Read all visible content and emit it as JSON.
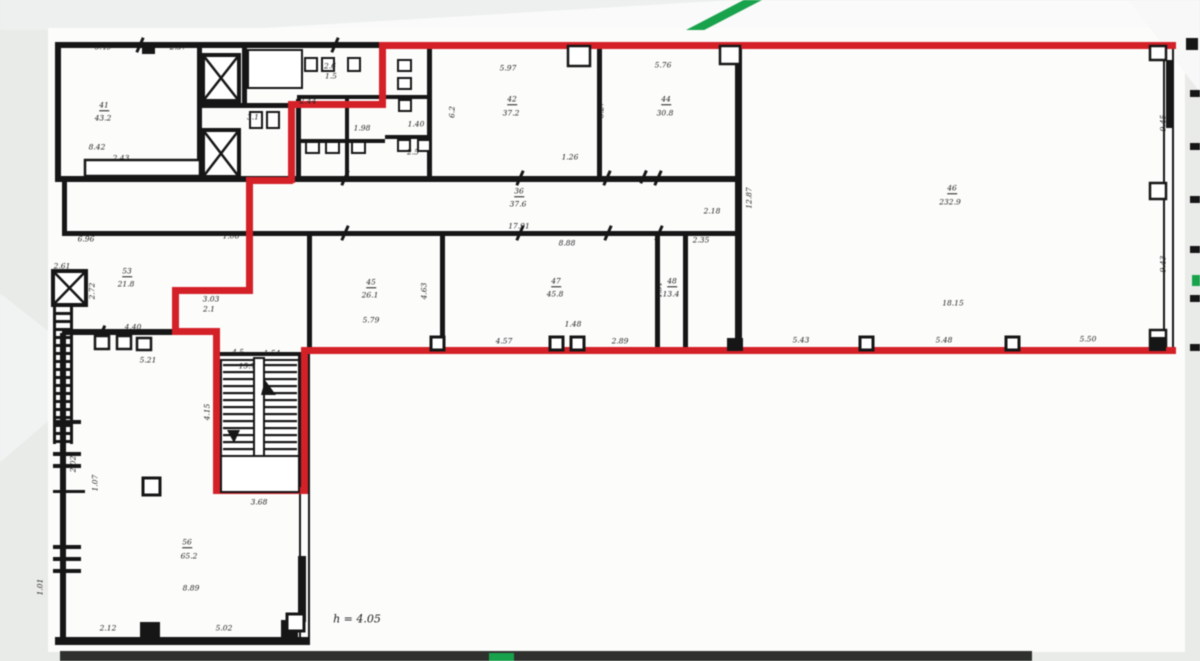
{
  "document": {
    "type": "scanned-floor-plan",
    "height_note": "h = 4.05",
    "colors": {
      "outline_red": "#d32127",
      "watermark_green": "#18a24c",
      "wall_black": "#161616",
      "paper": "#fcfcfb",
      "band_dark": "#30312f"
    }
  },
  "plan": {
    "labels": [
      {
        "t": "5.49",
        "x": 103,
        "y": 47
      },
      {
        "t": "2.37",
        "x": 178,
        "y": 47
      },
      {
        "t": "41",
        "x": 104,
        "y": 106,
        "u": 1
      },
      {
        "t": "43.2",
        "x": 103,
        "y": 118
      },
      {
        "t": "8.42",
        "x": 97,
        "y": 147
      },
      {
        "t": "2.43",
        "x": 121,
        "y": 158
      },
      {
        "t": "2.6",
        "x": 330,
        "y": 66
      },
      {
        "t": "1.5",
        "x": 331,
        "y": 76
      },
      {
        "t": "3.1",
        "x": 253,
        "y": 117
      },
      {
        "t": "2.44",
        "x": 308,
        "y": 101
      },
      {
        "t": "1.98",
        "x": 362,
        "y": 128
      },
      {
        "t": "1.40",
        "x": 416,
        "y": 124
      },
      {
        "t": "2.5",
        "x": 413,
        "y": 152
      },
      {
        "t": "6.2",
        "x": 452,
        "y": 112,
        "r": -90
      },
      {
        "t": "5.97",
        "x": 508,
        "y": 68
      },
      {
        "t": "42",
        "x": 512,
        "y": 100,
        "u": 1
      },
      {
        "t": "37.2",
        "x": 511,
        "y": 113
      },
      {
        "t": "6.27",
        "x": 601,
        "y": 110,
        "r": -90
      },
      {
        "t": "1.26",
        "x": 570,
        "y": 157
      },
      {
        "t": "5.76",
        "x": 663,
        "y": 65
      },
      {
        "t": "44",
        "x": 666,
        "y": 100,
        "u": 1
      },
      {
        "t": "30.8",
        "x": 665,
        "y": 113
      },
      {
        "t": "6.96",
        "x": 86,
        "y": 239
      },
      {
        "t": "1.06",
        "x": 231,
        "y": 236
      },
      {
        "t": "36",
        "x": 519,
        "y": 192,
        "u": 1
      },
      {
        "t": "37.6",
        "x": 518,
        "y": 204
      },
      {
        "t": "17.91",
        "x": 519,
        "y": 226
      },
      {
        "t": "8.88",
        "x": 567,
        "y": 243
      },
      {
        "t": "2.18",
        "x": 712,
        "y": 211
      },
      {
        "t": "12.87",
        "x": 749,
        "y": 198,
        "r": -90
      },
      {
        "t": "2.35",
        "x": 701,
        "y": 240
      },
      {
        "t": "2.61",
        "x": 62,
        "y": 266
      },
      {
        "t": "2.72",
        "x": 92,
        "y": 291,
        "r": -90
      },
      {
        "t": "53",
        "x": 127,
        "y": 272,
        "u": 1
      },
      {
        "t": "21.8",
        "x": 126,
        "y": 284
      },
      {
        "t": "4.40",
        "x": 133,
        "y": 327
      },
      {
        "t": "5.21",
        "x": 148,
        "y": 360
      },
      {
        "t": "3.03",
        "x": 211,
        "y": 299
      },
      {
        "t": "2.1",
        "x": 209,
        "y": 309
      },
      {
        "t": "45",
        "x": 371,
        "y": 283,
        "u": 1
      },
      {
        "t": "26.1",
        "x": 370,
        "y": 295
      },
      {
        "t": "5.79",
        "x": 371,
        "y": 320
      },
      {
        "t": "4.63",
        "x": 424,
        "y": 291,
        "r": -90
      },
      {
        "t": "47",
        "x": 556,
        "y": 282,
        "u": 1
      },
      {
        "t": "45.8",
        "x": 555,
        "y": 294
      },
      {
        "t": "1.48",
        "x": 573,
        "y": 324
      },
      {
        "t": "4.57",
        "x": 504,
        "y": 341
      },
      {
        "t": "2.89",
        "x": 620,
        "y": 341
      },
      {
        "t": "48",
        "x": 672,
        "y": 282,
        "u": 1
      },
      {
        "t": "13.4",
        "x": 671,
        "y": 294
      },
      {
        "t": "4.51",
        "x": 659,
        "y": 290,
        "r": -90
      },
      {
        "t": "46",
        "x": 952,
        "y": 189,
        "u": 1
      },
      {
        "t": "232.9",
        "x": 950,
        "y": 202
      },
      {
        "t": "18.15",
        "x": 953,
        "y": 303
      },
      {
        "t": "5.43",
        "x": 801,
        "y": 340
      },
      {
        "t": "5.48",
        "x": 944,
        "y": 340
      },
      {
        "t": "5.50",
        "x": 1088,
        "y": 339
      },
      {
        "t": "9.45",
        "x": 1163,
        "y": 123,
        "r": -90
      },
      {
        "t": "9.43",
        "x": 1163,
        "y": 264,
        "r": -90
      },
      {
        "t": "4.5",
        "x": 238,
        "y": 352
      },
      {
        "t": "1.54",
        "x": 272,
        "y": 353
      },
      {
        "t": "15.7",
        "x": 247,
        "y": 366
      },
      {
        "t": "4.15",
        "x": 207,
        "y": 412,
        "r": -90
      },
      {
        "t": "3.68",
        "x": 259,
        "y": 502
      },
      {
        "t": "2.02",
        "x": 73,
        "y": 464,
        "r": -90
      },
      {
        "t": "1.07",
        "x": 95,
        "y": 483,
        "r": -90
      },
      {
        "t": "1.01",
        "x": 40,
        "y": 587,
        "r": -90
      },
      {
        "t": "56",
        "x": 187,
        "y": 543,
        "u": 1
      },
      {
        "t": "65.2",
        "x": 189,
        "y": 556
      },
      {
        "t": "8.89",
        "x": 191,
        "y": 588
      },
      {
        "t": "2.12",
        "x": 108,
        "y": 628
      },
      {
        "t": "5.02",
        "x": 224,
        "y": 628
      },
      {
        "t": "h = 4.05",
        "x": 357,
        "y": 619,
        "s": 11
      }
    ]
  }
}
